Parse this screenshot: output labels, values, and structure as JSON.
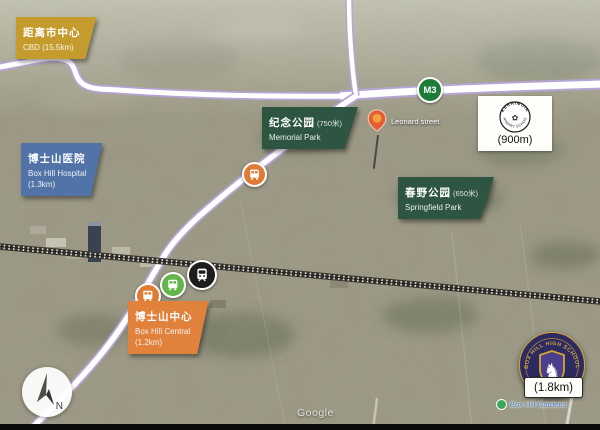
{
  "title": "Box Hill aerial location map",
  "watermark": "Google",
  "compass": {
    "north_label": "N"
  },
  "freeway": {
    "badge": "M3"
  },
  "labels": {
    "cbd": {
      "line1": "距离市中心",
      "line2": "CBD (15.5km)"
    },
    "hospital": {
      "zh": "博士山医院",
      "en": "Box Hill Hospital",
      "distance": "(1.3km)"
    },
    "memorial_park": {
      "zh": "纪念公园",
      "distance_zh": "(750米)",
      "en": "Memorial Park"
    },
    "springfield_park": {
      "zh": "春野公园",
      "distance_zh": "(650米)",
      "en": "Springfield Park"
    },
    "box_hill_central": {
      "zh": "博士山中心",
      "en": "Box Hill Central",
      "distance": "(1.2km)"
    },
    "property": {
      "street": "Leonard street"
    },
    "kerrimuir_school": {
      "arc_top": "KERRIMUIR",
      "arc_bottom": "PRIMARY SCHOOL",
      "distance": "(900m)"
    },
    "high_school": {
      "arc": "BOX HILL HIGH SCHOOL",
      "distance": "(1.8km)"
    },
    "poi": {
      "name": "Box Hill Gardens"
    }
  },
  "icons": {
    "map-pin-icon": "teardrop svg shape",
    "bus-icon": "svg bus glyph",
    "train-icon": "svg train glyph",
    "tree-icon": "green dot",
    "compass-north-icon": "svg arrow",
    "school-crest-horse-icon": "♞",
    "school-logo-flower-icon": "✿"
  },
  "colors": {
    "cbd_label": "#c49b2c",
    "park_label": "#2e5541",
    "hospital_label": "#5273a8",
    "central_label": "#e0813c",
    "bus_orange": "#e07b35",
    "bus_green": "#62b54a",
    "train_black": "#1d1d1b",
    "freeway_green": "#1e7c39",
    "pin_body": "#e85c33",
    "pin_dot": "#f2a43c",
    "road_edge": "#b5a5d6",
    "badge_navy": "#2d2a62",
    "badge_gold": "#d3a433",
    "poi_green": "#3aa757",
    "poi_text": "#4e7fc1"
  }
}
